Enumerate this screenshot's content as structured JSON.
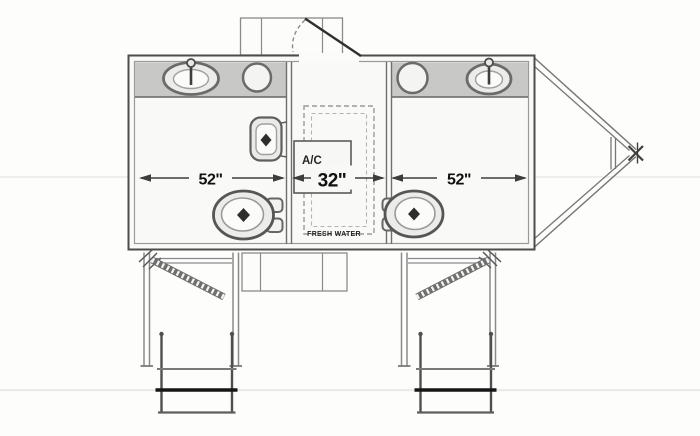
{
  "dims": {
    "left": "52\"",
    "center": "32\"",
    "right": "52\""
  },
  "labels": {
    "ac": "A/C",
    "fresh_water": "FRESH WATER"
  },
  "fixtures": {
    "left_room": [
      "oval-sink",
      "counter-basin-circle",
      "urinal",
      "toilet"
    ],
    "center_utility": [
      "ac-unit",
      "fresh-water-tank"
    ],
    "right_room": [
      "counter-basin-circle",
      "oval-sink",
      "toilet"
    ],
    "exterior": [
      "roof-vent-box",
      "tank-box",
      "entry-landing-left",
      "entry-steps-left",
      "entry-landing-right",
      "entry-steps-right",
      "v-tongue-hitch",
      "tongue-jack"
    ]
  },
  "colors": {
    "wall": "#4d4d4d",
    "inner_line": "#9a9a9a",
    "counter_fill": "#c8c8c6",
    "step_accent": "#161616",
    "background": "#fdfdfc"
  }
}
